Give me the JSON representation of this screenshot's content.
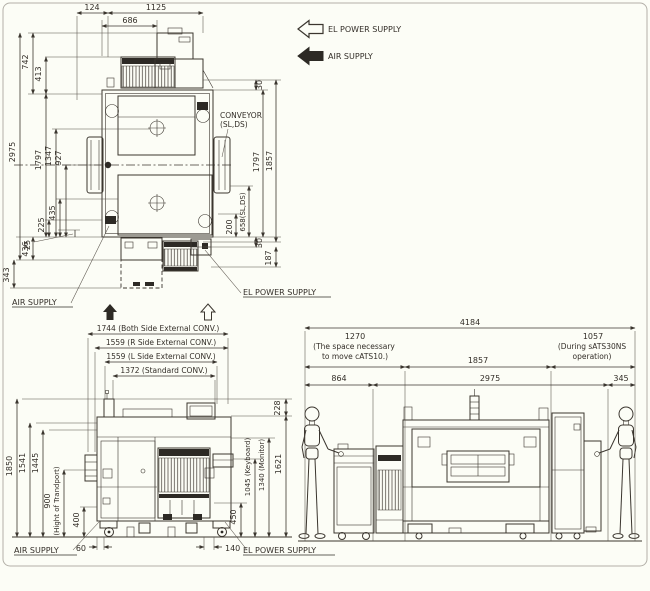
{
  "legend": {
    "el_power_supply": "EL POWER SUPPLY",
    "air_supply": "AIR SUPPLY"
  },
  "top_view": {
    "dims": {
      "w124": "124",
      "w1125": "1125",
      "w686": "686",
      "l742": "742",
      "l413": "413",
      "l2975": "2975",
      "l1797": "1797",
      "l1347": "1347",
      "l927": "927",
      "l435": "435",
      "l225": "225",
      "l25": "25",
      "l436": "436",
      "l343": "343",
      "r30_top": "30",
      "r1797": "1797",
      "r1857": "1857",
      "r200": "200",
      "r658": "658(SL,DS)",
      "r30_bottom": "30",
      "r187": "187"
    },
    "labels": {
      "conveyor_1": "CONVEYOR",
      "conveyor_2": "(SL,DS)",
      "air_supply": "AIR SUPPLY",
      "el_power_supply": "EL POWER SUPPLY"
    }
  },
  "front_view": {
    "dims": {
      "w1744": "1744 (Both Side External CONV.)",
      "w1559r": "1559 (R Side External CONV.)",
      "w1559l": "1559 (L Side External CONV.)",
      "w1372": "1372 (Standard CONV.)",
      "l1850": "1850",
      "l1541": "1541",
      "l1445": "1445",
      "l900": "900",
      "l900_note": "(Hight of Trandport)",
      "l400": "400",
      "r228": "228",
      "r1621": "1621",
      "r1340": "1340 (Monitor)",
      "r1045": "1045 (Keyboard)",
      "r450": "450",
      "b60": "60",
      "b140": "140"
    },
    "labels": {
      "air_supply": "AIR SUPPLY",
      "el_power_supply": "EL POWER SUPPLY"
    }
  },
  "side_view": {
    "dims": {
      "w4184": "4184",
      "w1270": "1270",
      "w1270_note1": "(The space necessary",
      "w1270_note2": "to move cATS10.)",
      "w1857": "1857",
      "w1057": "1057",
      "w1057_note1": "(During sATS30NS",
      "w1057_note2": "operation)",
      "w864": "864",
      "w2975": "2975",
      "w345": "345"
    }
  },
  "colors": {
    "line": "#3b362f",
    "text": "#332e28",
    "background": "#fcfdf6",
    "dark_fill": "#2d2a25"
  }
}
